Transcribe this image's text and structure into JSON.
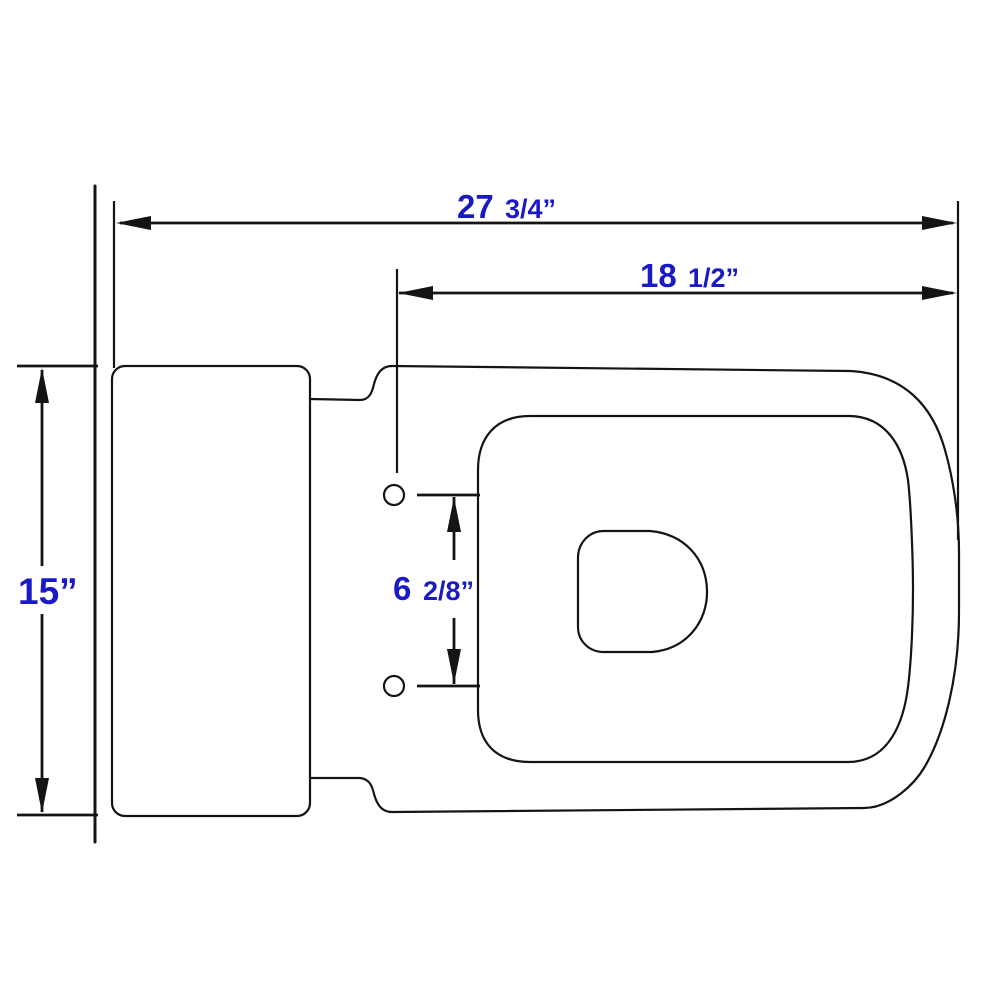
{
  "colors": {
    "background": "#ffffff",
    "line": "#141414",
    "dimension_text": "#1a1ac4"
  },
  "dimensions": {
    "overall_depth": {
      "big": "27",
      "small": "3/4”"
    },
    "seat_depth": {
      "big": "18",
      "small": "1/2”"
    },
    "overall_width": {
      "big": "15”",
      "small": ""
    },
    "bolt_hole_spacing": {
      "big": "6",
      "small": "2/8”"
    }
  }
}
